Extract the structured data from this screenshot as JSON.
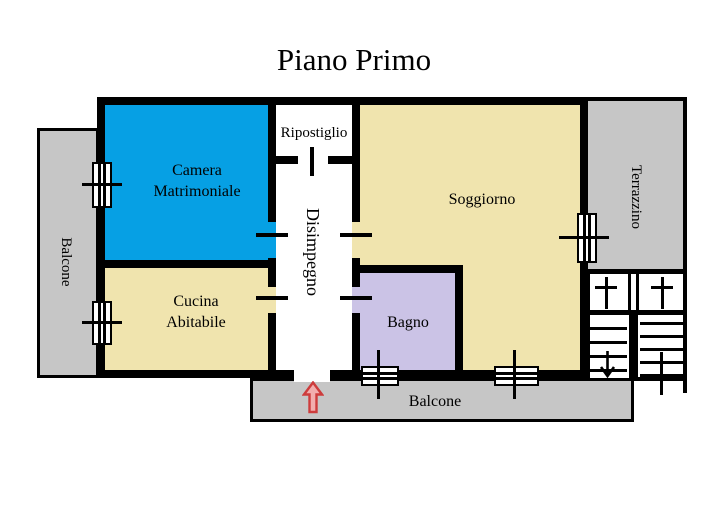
{
  "title": "Piano Primo",
  "rooms": {
    "camera_matrimoniale": {
      "label": "Camera Matrimoniale",
      "floor_color": "#06A0E4"
    },
    "ripostiglio": {
      "label": "Ripostiglio",
      "floor_color": "#FFFFFF"
    },
    "disimpegno": {
      "label": "Disimpegno",
      "floor_color": "#FFFFFF"
    },
    "soggiorno": {
      "label": "Soggiorno",
      "floor_color": "#F0E4AE"
    },
    "cucina_abitabile": {
      "label": "Cucina Abitabile",
      "floor_color": "#F0E4AE"
    },
    "bagno": {
      "label": "Bagno",
      "floor_color": "#CBC3E6"
    }
  },
  "exterior": {
    "balcone_left": {
      "label": "Balcone",
      "floor_color": "#C6C6C6"
    },
    "terrazzino": {
      "label": "Terrazzino",
      "floor_color": "#C6C6C6"
    },
    "balcone_bottom": {
      "label": "Balcone",
      "floor_color": "#C6C6C6"
    }
  },
  "features": {
    "wall_color": "#000000",
    "entrance_arrow": {
      "stroke": "#CD3C3C",
      "fill": "#F2AEAE",
      "direction": "up"
    },
    "stairs": {
      "direction_mark": "down-arrow"
    }
  }
}
